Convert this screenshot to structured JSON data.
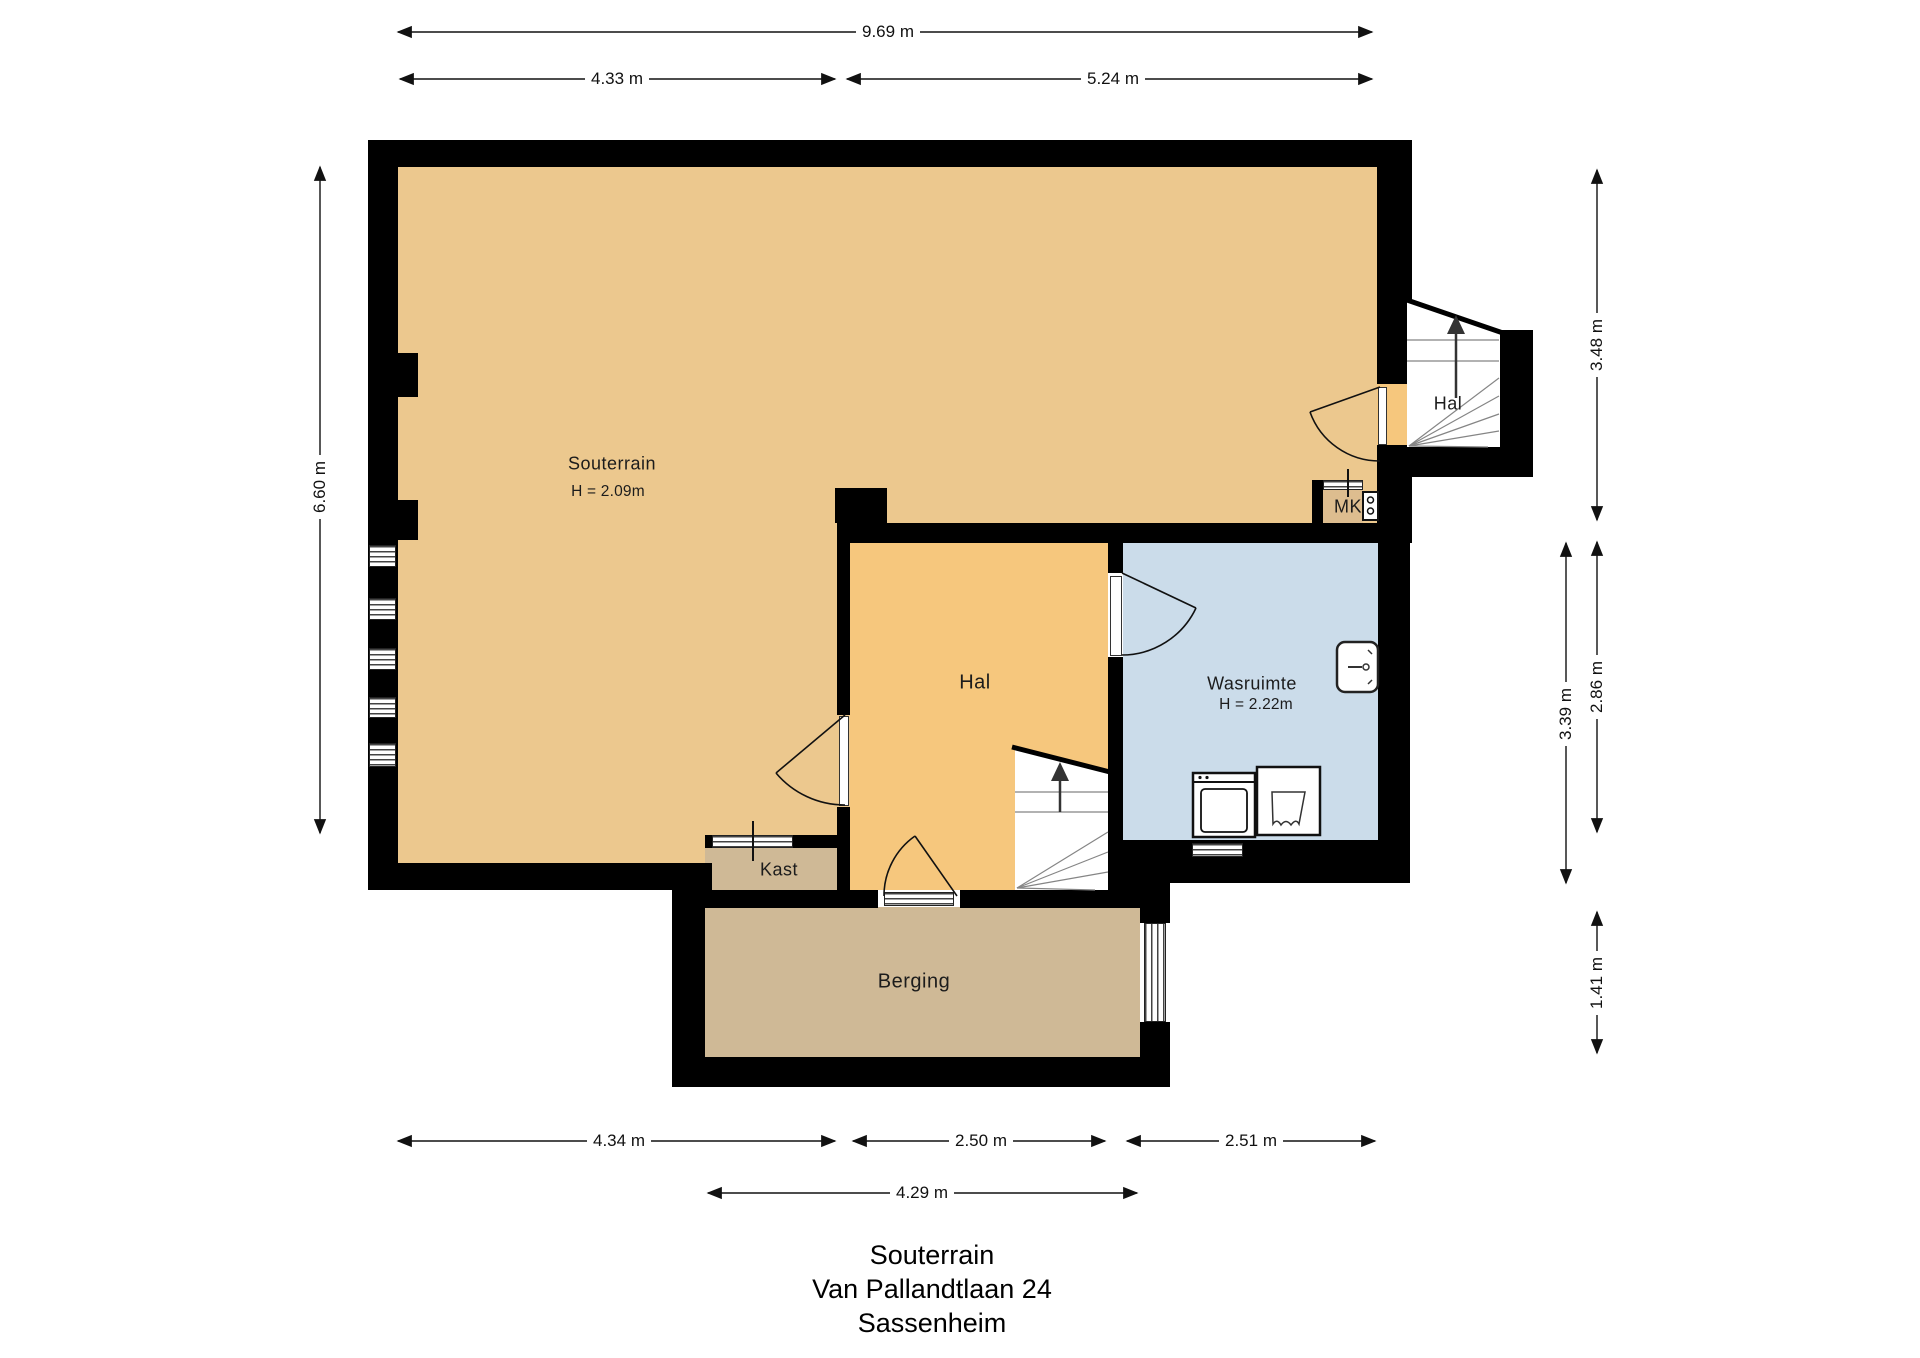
{
  "title": {
    "line1": "Souterrain",
    "line2": "Van Pallandtlaan 24",
    "line3": "Sassenheim"
  },
  "rooms": {
    "souterrain": {
      "name": "Souterrain",
      "height_label": "H = 2.09m"
    },
    "hal_top": {
      "name": "Hal"
    },
    "mk": {
      "name": "MK"
    },
    "hal_center": {
      "name": "Hal"
    },
    "wasruimte": {
      "name": "Wasruimte",
      "height_label": "H = 2.22m"
    },
    "kast": {
      "name": "Kast"
    },
    "berging": {
      "name": "Berging"
    }
  },
  "dimensions": [
    {
      "label": "9.69 m",
      "edge": "top"
    },
    {
      "label": "4.33 m",
      "edge": "top"
    },
    {
      "label": "5.24 m",
      "edge": "top"
    },
    {
      "label": "6.60 m",
      "edge": "left"
    },
    {
      "label": "3.48 m",
      "edge": "right"
    },
    {
      "label": "2.86 m",
      "edge": "right"
    },
    {
      "label": "1.41 m",
      "edge": "right"
    },
    {
      "label": "3.39 m",
      "edge": "right"
    },
    {
      "label": "4.34 m",
      "edge": "bottom"
    },
    {
      "label": "2.50 m",
      "edge": "bottom"
    },
    {
      "label": "2.51 m",
      "edge": "bottom"
    },
    {
      "label": "4.29 m",
      "edge": "bottom"
    }
  ],
  "icons": {
    "stairs_up_arrow": "stairs-up-arrow-icon",
    "shower": "shower-icon",
    "washing_machine": "washing-machine-icon",
    "sink": "laundry-sink-icon",
    "meter_box": "meter-box-icon"
  },
  "colors": {
    "wall": "#000000",
    "souterrain": "#ECC88E",
    "hal": "#F6C77D",
    "wasruimte": "#CBDCEA",
    "berging": "#CFB996",
    "kast": "#CFB996",
    "mk": "#DDBD8F",
    "dimension": "#111111"
  }
}
